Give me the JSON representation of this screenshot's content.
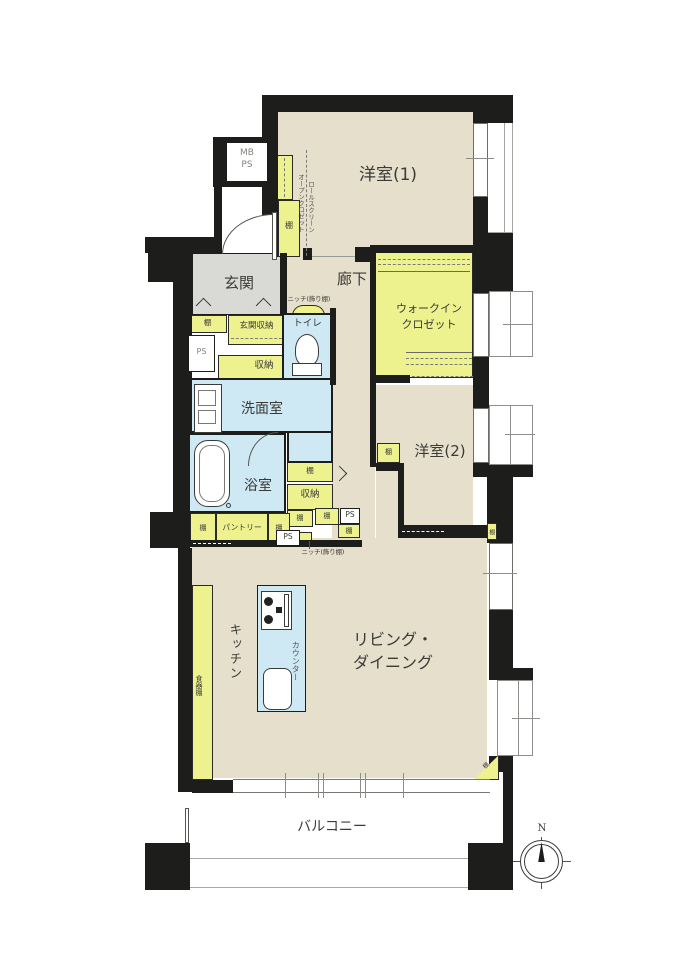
{
  "plan_title": "apartment-floor-plan",
  "colors": {
    "wall": "#1d1d1b",
    "floor_beige": "#e6dfcc",
    "closet_yellow": "#edf18e",
    "wet_area_blue": "#cfe9f4",
    "entrance_gray": "#d9d9d6"
  },
  "rooms": {
    "western1": "洋室(1)",
    "western2": "洋室(2)",
    "entrance": "玄関",
    "corridor": "廊下",
    "wic_line1": "ウォークイン",
    "wic_line2": "クロゼット",
    "toilet": "トイレ",
    "washroom": "洗面室",
    "bathroom": "浴室",
    "kitchen": "キッチン",
    "living_dining_line1": "リビング・",
    "living_dining_line2": "ダイニング",
    "balcony": "バルコニー"
  },
  "labels": {
    "mb": "MB",
    "ps": "PS",
    "shelf": "棚",
    "storage": "収納",
    "entrance_storage": "玄関収納",
    "pantry": "パントリー",
    "cupboard": "食器棚",
    "counter": "カウンター",
    "niche": "ニッチ(飾り棚)",
    "open_closet": "オープンクロゼット",
    "roll_screen": "ロールスクリーン",
    "north": "N"
  }
}
